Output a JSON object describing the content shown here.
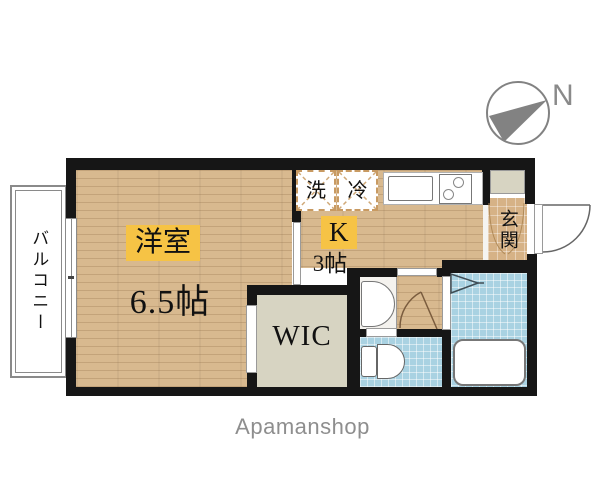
{
  "floorplan": {
    "balcony": "バルコニー",
    "western_room": {
      "name": "洋室",
      "size": "6.5帖"
    },
    "kitchen": {
      "name": "K",
      "size": "3帖"
    },
    "wic": "WIC",
    "entrance": "玄関",
    "washer": "洗",
    "fridge": "冷",
    "compass_north": "N",
    "watermark": "Apamanshop",
    "colors": {
      "wall": "#161616",
      "wood_floor": "#d8b98f",
      "blue_tile": "#a9d2e2",
      "wic_floor": "#d7d4c2",
      "label_highlight": "#f6c345",
      "compass_gray": "#828282"
    }
  }
}
